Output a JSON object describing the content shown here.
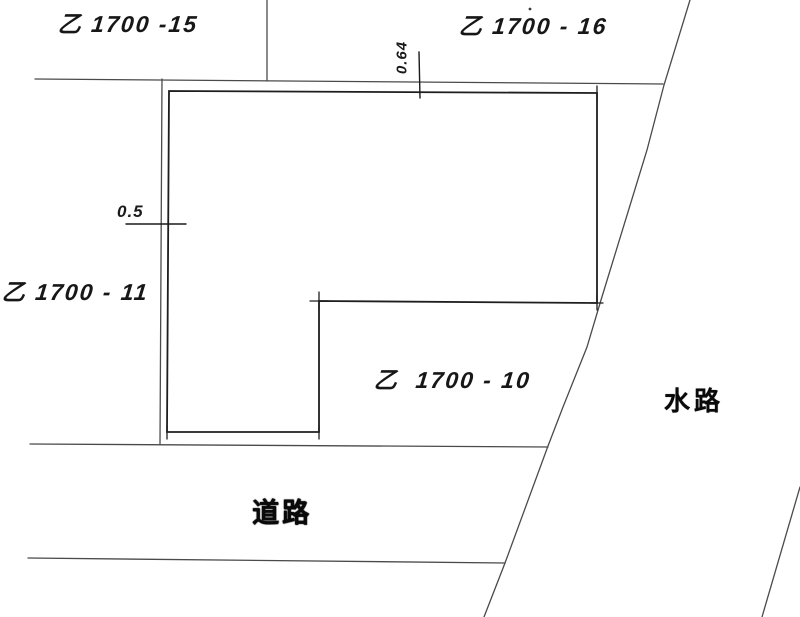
{
  "labels": {
    "parcel_top_left": "乙 1700 -15",
    "parcel_top_right": "乙 1700 - 16",
    "parcel_left": "乙 1700 - 11",
    "parcel_bottom": "乙  1700 - 10",
    "waterway": "水路",
    "road": "道路"
  },
  "measurements": {
    "left_strip_width": "0.5",
    "top_strip_width": "0.64"
  },
  "colors": {
    "paper": "#ffffff",
    "boundary_line": "#4a4a4a",
    "parcel_outline": "#1e1e1e",
    "ink": "#141414"
  }
}
